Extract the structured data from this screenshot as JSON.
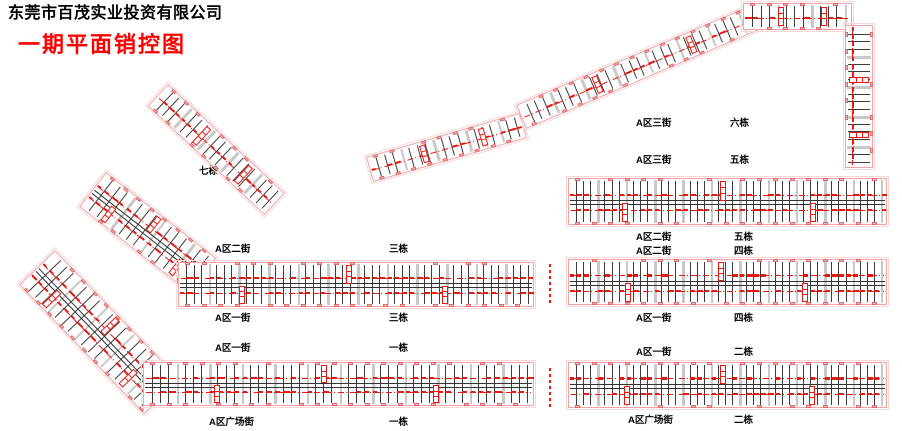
{
  "header": {
    "company": "东莞市百茂实业投资有限公司",
    "title": "一期平面销控图"
  },
  "labels": {
    "b7": {
      "building": "七栋"
    },
    "a2_3": {
      "street": "A区二街",
      "building": "三栋"
    },
    "a1_3": {
      "street": "A区一街",
      "building": "三栋"
    },
    "a1_1": {
      "street": "A区一街",
      "building": "一栋"
    },
    "pl_1": {
      "street": "A区广场街",
      "building": "一栋"
    },
    "a3_6": {
      "street": "A区三街",
      "building": "六栋"
    },
    "a3_5": {
      "street": "A区三街",
      "building": "五栋"
    },
    "a2_5": {
      "street": "A区二街",
      "building": "五栋"
    },
    "a2_4": {
      "street": "A区二街",
      "building": "四栋"
    },
    "a1_4": {
      "street": "A区一街",
      "building": "四栋"
    },
    "a1_2": {
      "street": "A区一街",
      "building": "二栋"
    },
    "pl_2": {
      "street": "A区广场街",
      "building": "二栋"
    }
  },
  "colors": {
    "title_red": "#ff0000",
    "plan_red": "#e8170f",
    "outline_pink": "#efa3a3",
    "outline_pink_light": "#f8d7d7",
    "square_pink": "#f5b5b5",
    "square_border": "#e26a6a",
    "divider_dark": "#3c3c3c",
    "band_gray": "#c8c8c8"
  }
}
